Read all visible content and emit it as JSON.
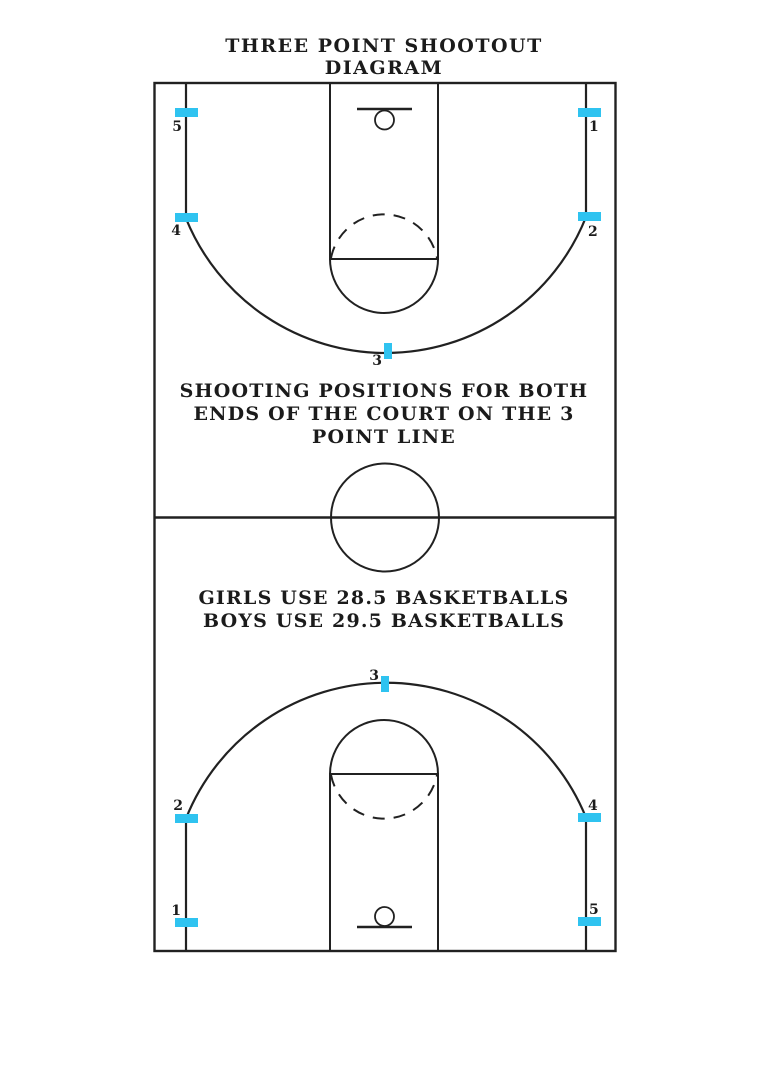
{
  "title": {
    "line1": "THREE POINT SHOOTOUT",
    "line2": "DIAGRAM"
  },
  "notes": {
    "positions_line1": "SHOOTING POSITIONS FOR BOTH",
    "positions_line2": "ENDS OF THE COURT ON THE 3",
    "positions_line3": "POINT LINE",
    "balls_line1": "GIRLS USE 28.5 BASKETBALLS",
    "balls_line2": "BOYS USE 29.5 BASKETBALLS"
  },
  "colors": {
    "line": "#212121",
    "marker": "#2fc3f0",
    "text": "#1b1b1b",
    "background": "#ffffff"
  },
  "court": {
    "description": "full basketball court, both ends, five marked three-point shooting positions per end",
    "markers": [
      {
        "id": "top-5",
        "half": "top",
        "label": "5",
        "x": 175,
        "y": 108,
        "w": 23,
        "h": 9,
        "lx": 182,
        "ly": 131,
        "anchor": "end"
      },
      {
        "id": "top-4",
        "half": "top",
        "label": "4",
        "x": 175,
        "y": 213,
        "w": 23,
        "h": 9,
        "lx": 181,
        "ly": 235,
        "anchor": "end"
      },
      {
        "id": "top-1",
        "half": "top",
        "label": "1",
        "x": 578,
        "y": 108,
        "w": 23,
        "h": 9,
        "lx": 589,
        "ly": 131,
        "anchor": "start"
      },
      {
        "id": "top-2",
        "half": "top",
        "label": "2",
        "x": 578,
        "y": 212,
        "w": 23,
        "h": 9,
        "lx": 588,
        "ly": 236,
        "anchor": "start"
      },
      {
        "id": "top-3",
        "half": "top",
        "label": "3",
        "x": 384,
        "y": 343,
        "w": 8,
        "h": 16,
        "lx": 382,
        "ly": 365,
        "anchor": "end"
      },
      {
        "id": "bottom-3",
        "half": "bottom",
        "label": "3",
        "x": 381,
        "y": 676,
        "w": 8,
        "h": 16,
        "lx": 379,
        "ly": 680,
        "anchor": "end"
      },
      {
        "id": "bottom-2",
        "half": "bottom",
        "label": "2",
        "x": 175,
        "y": 814,
        "w": 23,
        "h": 9,
        "lx": 183,
        "ly": 810,
        "anchor": "end"
      },
      {
        "id": "bottom-1",
        "half": "bottom",
        "label": "1",
        "x": 175,
        "y": 918,
        "w": 23,
        "h": 9,
        "lx": 181,
        "ly": 915,
        "anchor": "end"
      },
      {
        "id": "bottom-4",
        "half": "bottom",
        "label": "4",
        "x": 578,
        "y": 813,
        "w": 23,
        "h": 9,
        "lx": 588,
        "ly": 810,
        "anchor": "start"
      },
      {
        "id": "bottom-5",
        "half": "bottom",
        "label": "5",
        "x": 578,
        "y": 917,
        "w": 23,
        "h": 9,
        "lx": 589,
        "ly": 914,
        "anchor": "start"
      }
    ]
  }
}
